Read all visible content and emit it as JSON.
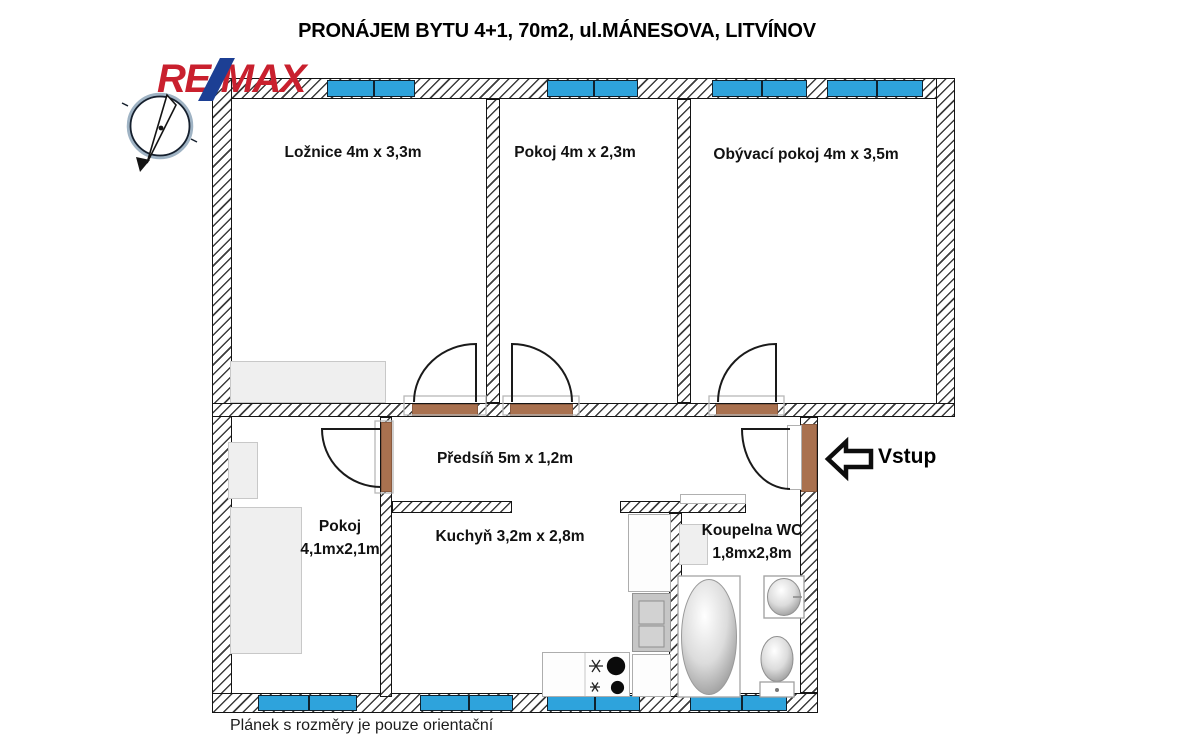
{
  "header": {
    "title": "PRONÁJEM BYTU 4+1, 70m2, ul.MÁNESOVA, LITVÍNOV"
  },
  "logo": {
    "re": "RE",
    "max": "MAX",
    "red": "#c9202e",
    "blue": "#1c3f94"
  },
  "plan": {
    "rooms": {
      "loznice": {
        "label": "Ložnice 4m x 3,3m"
      },
      "pokoj_horni": {
        "label": "Pokoj 4m x 2,3m"
      },
      "obyvaci_pokoj": {
        "label": "Obývací pokoj 4m x 3,5m"
      },
      "predsin": {
        "label": "Předsíň 5m x 1,2m"
      },
      "pokoj_dolni": {
        "name": "Pokoj",
        "dimensions": "4,1mx2,1m"
      },
      "kuchyn": {
        "label": "Kuchyň 3,2m x 2,8m"
      },
      "koupelna": {
        "name": "Koupelna WC",
        "dimensions": "1,8mx2,8m"
      }
    },
    "entrance": {
      "label": "Vstup"
    },
    "colors": {
      "window_blue": "#2ea3dc",
      "door_brown": "#a9714f",
      "wall_hatch": "#3c3c3c",
      "furniture_grey": "#efefef"
    }
  },
  "footer": {
    "note": "Plánek s rozměry je pouze orientační"
  }
}
